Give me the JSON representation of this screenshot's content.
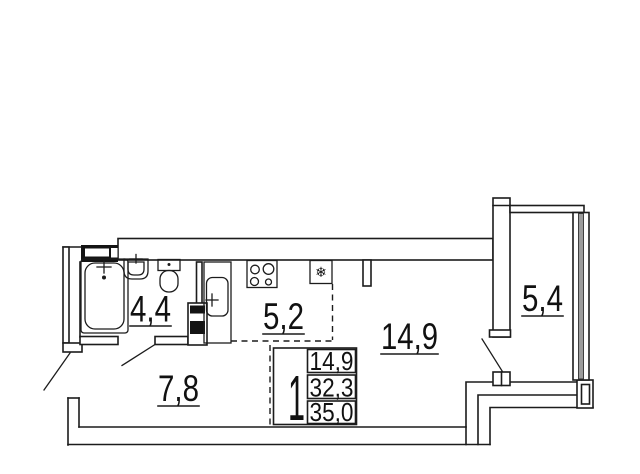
{
  "title": "Studio apartment floor plan",
  "rooms": {
    "bathroom": {
      "area": "4,4"
    },
    "kitchen": {
      "area": "5,2"
    },
    "living": {
      "area": "14,9"
    },
    "hallway": {
      "area": "7,8"
    },
    "balcony": {
      "area": "5,4"
    }
  },
  "stamp": {
    "room_count": "1",
    "living_area": "14,9",
    "apartment_area": "32,3",
    "total_area": "35,0"
  },
  "icons": {
    "snowflake_glyph": "❄"
  },
  "colors": {
    "line": "#1c1c1c",
    "background": "#ffffff",
    "glazing_fill": "#9c9c9c"
  }
}
